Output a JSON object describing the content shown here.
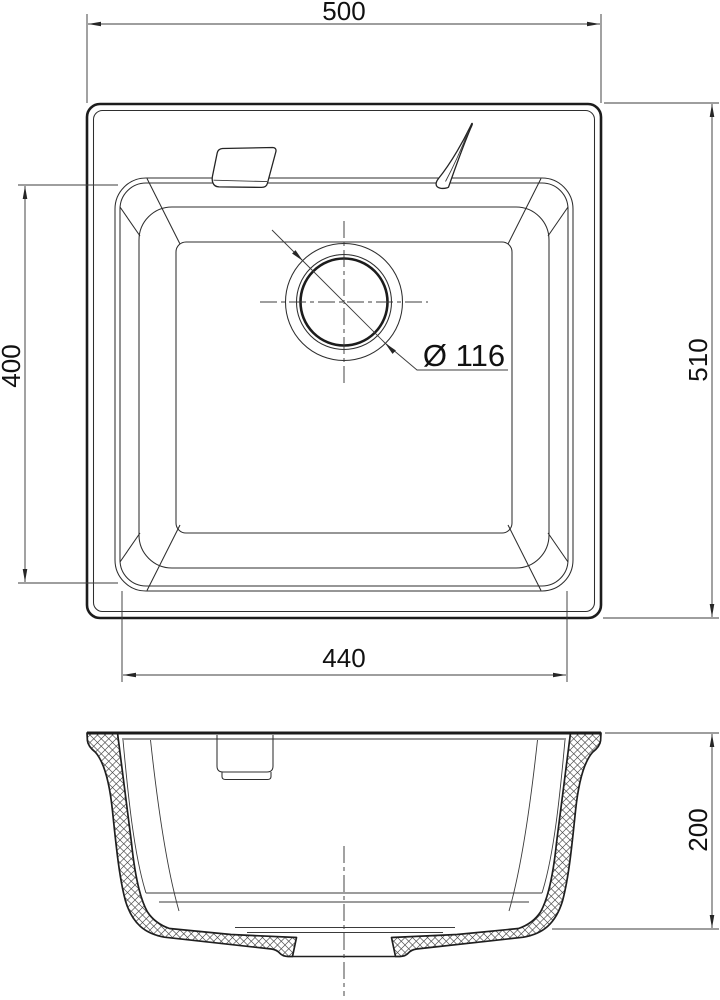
{
  "drawing": {
    "dimensions": {
      "overall_width": "500",
      "overall_length": "510",
      "bowl_length": "400",
      "bowl_width": "440",
      "drain": "Ø 116",
      "depth": "200"
    },
    "colors": {
      "line": "#1c1c1c",
      "dimension": "#3d3d3d",
      "background": "#ffffff"
    }
  }
}
